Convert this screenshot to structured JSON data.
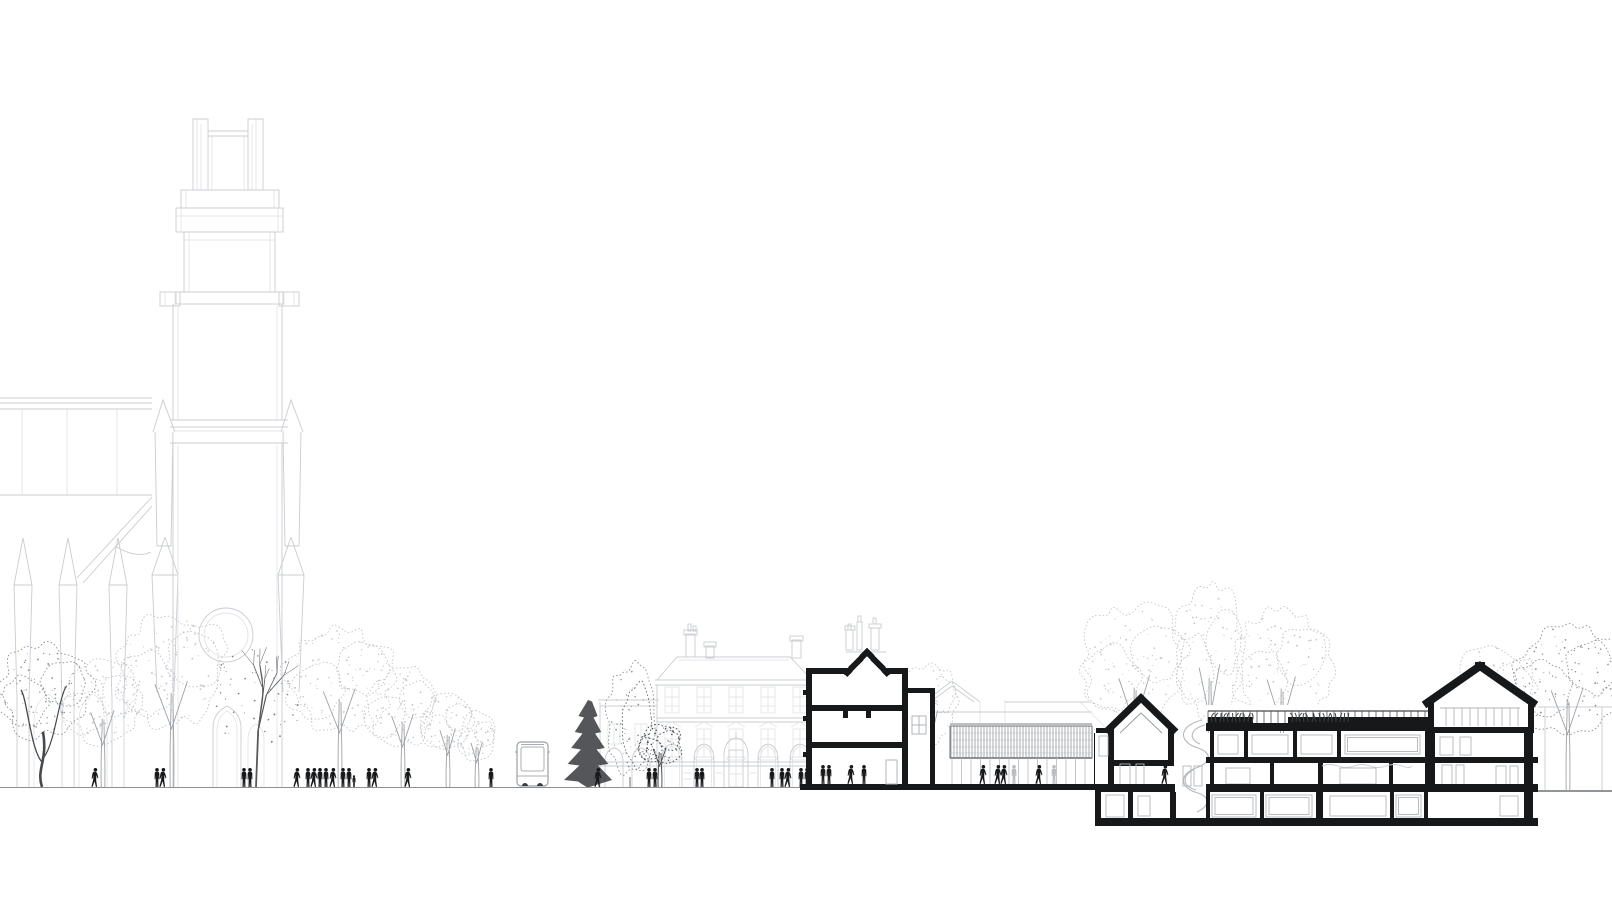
{
  "document": {
    "type": "architectural street elevation and section drawing",
    "visible_text": []
  },
  "palette": {
    "background": "#ffffff",
    "faint_line": "#c9ccd1",
    "light_tree": "#c2c6ca",
    "mid": "#8f9397",
    "dark": "#474a4d",
    "ink": "#17181a",
    "ghost_figure": "#b9bdc1",
    "window_frame": "#b2b6ba",
    "rail": "#515457",
    "ground": "#8d9094"
  },
  "scene": {
    "ground_y": 787,
    "right_ground_y": 791,
    "trees": [
      {
        "kind": "gnarly",
        "cx": 45,
        "top": 642,
        "w": 96,
        "tone": "mid"
      },
      {
        "kind": "round",
        "cx": 103,
        "top": 660,
        "w": 82,
        "tone": "light"
      },
      {
        "kind": "round",
        "cx": 172,
        "top": 612,
        "w": 114,
        "tone": "light"
      },
      {
        "kind": "bare",
        "cx": 256,
        "top": 652,
        "w": 96,
        "tone": "mid"
      },
      {
        "kind": "round",
        "cx": 340,
        "top": 624,
        "w": 112,
        "tone": "light"
      },
      {
        "kind": "round",
        "cx": 403,
        "top": 666,
        "w": 76,
        "tone": "light"
      },
      {
        "kind": "round",
        "cx": 448,
        "top": 690,
        "w": 54,
        "tone": "light"
      },
      {
        "kind": "round",
        "cx": 477,
        "top": 712,
        "w": 40,
        "tone": "light"
      },
      {
        "kind": "conifer",
        "cx": 588,
        "top": 700,
        "w": 48,
        "tone": "dark"
      },
      {
        "kind": "column",
        "cx": 630,
        "top": 660,
        "w": 48,
        "tone": "mid"
      },
      {
        "kind": "round",
        "cx": 660,
        "top": 722,
        "w": 46,
        "tone": "dark"
      },
      {
        "kind": "round",
        "cx": 930,
        "top": 660,
        "w": 56,
        "tone": "light",
        "layer": "back"
      },
      {
        "kind": "round",
        "cx": 1135,
        "top": 602,
        "w": 108,
        "tone": "light",
        "layer": "back"
      },
      {
        "kind": "round",
        "cx": 1210,
        "top": 584,
        "w": 72,
        "tone": "light",
        "layer": "back"
      },
      {
        "kind": "round",
        "cx": 1282,
        "top": 604,
        "w": 100,
        "tone": "light",
        "layer": "back"
      },
      {
        "kind": "round",
        "cx": 1495,
        "top": 642,
        "w": 82,
        "tone": "light",
        "layer": "back"
      },
      {
        "kind": "round",
        "cx": 1568,
        "top": 620,
        "w": 112,
        "tone": "mid",
        "layer": "back",
        "ground": 791
      }
    ],
    "people": [
      {
        "x": 95,
        "pose": "walk"
      },
      {
        "x": 157,
        "pose": "stand"
      },
      {
        "x": 163,
        "pose": "walk"
      },
      {
        "x": 244,
        "pose": "stand"
      },
      {
        "x": 250,
        "pose": "stand"
      },
      {
        "x": 297,
        "pose": "walk"
      },
      {
        "x": 308,
        "pose": "stand"
      },
      {
        "x": 314,
        "pose": "walk"
      },
      {
        "x": 320,
        "pose": "stand"
      },
      {
        "x": 326,
        "pose": "stand"
      },
      {
        "x": 333,
        "pose": "walk"
      },
      {
        "x": 343,
        "pose": "stand"
      },
      {
        "x": 349,
        "pose": "stand"
      },
      {
        "x": 354,
        "pose": "child"
      },
      {
        "x": 369,
        "pose": "stand"
      },
      {
        "x": 375,
        "pose": "walk"
      },
      {
        "x": 408,
        "pose": "walk"
      },
      {
        "x": 491,
        "pose": "stand"
      },
      {
        "x": 598,
        "pose": "walk"
      },
      {
        "x": 649,
        "pose": "stand"
      },
      {
        "x": 655,
        "pose": "stand"
      },
      {
        "x": 697,
        "pose": "stand"
      },
      {
        "x": 702,
        "pose": "stand"
      },
      {
        "x": 772,
        "pose": "stand"
      },
      {
        "x": 782,
        "pose": "stand"
      },
      {
        "x": 788,
        "pose": "walk"
      },
      {
        "x": 801,
        "pose": "stand"
      },
      {
        "x": 807,
        "pose": "stand"
      },
      {
        "x": 823,
        "pose": "stand",
        "y": 784
      },
      {
        "x": 829,
        "pose": "stand",
        "y": 784
      },
      {
        "x": 851,
        "pose": "walk",
        "y": 784
      },
      {
        "x": 864,
        "pose": "stand",
        "y": 784
      },
      {
        "x": 983,
        "pose": "walk",
        "y": 784
      },
      {
        "x": 998,
        "pose": "walk",
        "y": 784
      },
      {
        "x": 1004,
        "pose": "walk",
        "y": 784
      },
      {
        "x": 1014,
        "pose": "stand",
        "tone": "ghost",
        "y": 784
      },
      {
        "x": 1039,
        "pose": "walk",
        "y": 784
      },
      {
        "x": 1054,
        "pose": "stand",
        "tone": "ghost",
        "y": 784
      },
      {
        "x": 1165,
        "pose": "walk",
        "y": 784
      }
    ],
    "bus": {
      "x": 517,
      "y": 742,
      "w": 31,
      "h": 44
    },
    "pavilion": {
      "x": 950,
      "y": 726,
      "w": 142,
      "h": 32,
      "stripe_step": 3,
      "mullion_x1": 952,
      "mullion_x2": 1090,
      "mullion_step": 9.5,
      "mullion_y1": 758,
      "mullion_y2": 785
    },
    "roof_railing": {
      "x1": 1208,
      "x2": 1430,
      "step": 7,
      "y1": 711,
      "y2": 723
    },
    "attic_mullions": {
      "x1": 1446,
      "x2": 1518,
      "step": 8,
      "y1": 708,
      "y2": 726
    },
    "roof_plants": [
      {
        "from": 1212,
        "to": 1252
      },
      {
        "from": 1292,
        "to": 1350
      }
    ]
  }
}
